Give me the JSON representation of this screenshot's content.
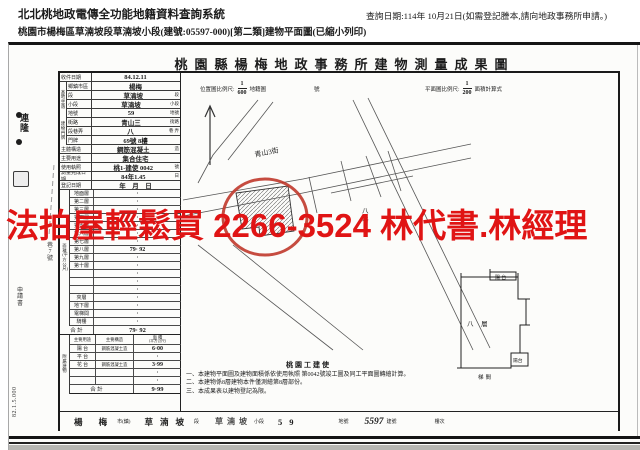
{
  "header": {
    "system_title": "北北桃地政電傳全功能地籍資料查詢系統",
    "query_date": "查詢日期:114年 10月21日(如需登記謄本,請向地政事務所申請。)",
    "doc_title": "桃園市楊梅區草湳坡段草湳坡小段(建號:05597-000)[第二類]建物平面圖(已縮小列印)"
  },
  "watermark": {
    "text": "法拍屋輕鬆買 2266-3524 林代書.林經理",
    "color": "#e01414"
  },
  "sheet": {
    "title": "桃園縣楊梅地政事務所建物測量成果圖",
    "scales": {
      "loc_label": "位置圖比例尺:",
      "loc_num": "1",
      "loc_den": "600",
      "loc_after": "地籍圖",
      "loc_no": "號",
      "plan_label": "平面圖比例尺:",
      "plan_num": "1",
      "plan_den": "200",
      "plan_after": "面積計算式"
    },
    "groups": {
      "g1": "基地坐落",
      "g2": "建物門牌"
    },
    "info_rows": [
      {
        "label": "收件日期",
        "value": "84.12.11",
        "unit": "",
        "cls": ""
      },
      {
        "label": "鄉鎮市區",
        "value": "楊梅",
        "unit": "",
        "cls": "g"
      },
      {
        "label": "段",
        "value": "草湳坡",
        "unit": "段",
        "cls": "g"
      },
      {
        "label": "小段",
        "value": "草湳坡",
        "unit": "小段",
        "cls": "g"
      },
      {
        "label": "地號",
        "value": "59",
        "unit": "地號",
        "cls": "g"
      },
      {
        "label": "街路",
        "value": "青山三",
        "unit": "街路",
        "cls": "g"
      },
      {
        "label": "段巷弄",
        "value": "八",
        "unit": "巷 弄",
        "cls": "g"
      },
      {
        "label": "門牌",
        "value": "69號 8樓",
        "unit": "",
        "cls": "g"
      },
      {
        "label": "主體構造",
        "value": "鋼筋混凝土",
        "unit": "造",
        "cls": ""
      },
      {
        "label": "主要用途",
        "value": "集合住宅",
        "unit": "",
        "cls": ""
      },
      {
        "label": "使用執照",
        "value": "桃1-建使 0042",
        "unit": "號",
        "cls": ""
      },
      {
        "label": "測量完成日期",
        "value": "84年1.45",
        "unit": "日",
        "cls": ""
      },
      {
        "label": "登記日期",
        "value": "年　月　日",
        "unit": "",
        "cls": ""
      }
    ],
    "floor": {
      "side": "面積(平方公尺)",
      "rows": [
        {
          "label": "地面層",
          "value": "·"
        },
        {
          "label": "第二層",
          "value": "·"
        },
        {
          "label": "第三層",
          "value": "·"
        },
        {
          "label": "第四層",
          "value": "·"
        },
        {
          "label": "第五層",
          "value": "·"
        },
        {
          "label": "第六層",
          "value": "·"
        },
        {
          "label": "第七層",
          "value": "·"
        },
        {
          "label": "第八層",
          "value": "79· 92"
        },
        {
          "label": "第九層",
          "value": "·"
        },
        {
          "label": "第十層",
          "value": "·"
        },
        {
          "label": "",
          "value": "·"
        },
        {
          "label": "",
          "value": "·"
        },
        {
          "label": "",
          "value": "·"
        },
        {
          "label": "夾層",
          "value": "·"
        },
        {
          "label": "地下層",
          "value": "·"
        },
        {
          "label": "電梯間",
          "value": "·"
        },
        {
          "label": "騎樓",
          "value": "·"
        }
      ],
      "total_label": "合 計",
      "total_value": "79· 92"
    },
    "annex": {
      "side": "附屬建物",
      "h_use": "主要用途",
      "h_struct": "主要構造",
      "h_area": "面 積",
      "h_area_sub": "(平方公尺)",
      "rows": [
        {
          "use": "陽 台",
          "struct": "鋼筋混凝土造",
          "area": "6·00"
        },
        {
          "use": "平 台",
          "struct": "",
          "area": "·"
        },
        {
          "use": "花 台",
          "struct": "鋼筋混凝土造",
          "area": "3·99"
        },
        {
          "use": "",
          "struct": "",
          "area": "·"
        },
        {
          "use": "",
          "struct": "",
          "area": "·"
        }
      ],
      "total_label": "合 計",
      "total_area": "9·99"
    },
    "notes": {
      "title": "桃園工建使",
      "lines": [
        {
          "t": "一、本建物平面圖及建物面積係依使用執照 第0042號竣工圖及同工平面圖轉繪計算。"
        },
        {
          "t": "二、本建物係8層建物本件僅測繪第8層部份。"
        },
        {
          "t": "三、本成果表以建物登記為限。"
        }
      ]
    },
    "sketch": {
      "street": "青山3街",
      "lane_a": "八",
      "lane_b": "巷",
      "floor_label": "八 層",
      "balcony_top": "陽 台",
      "balcony_bottom": "陽台",
      "stair": "梯間"
    },
    "bottom": [
      {
        "text": "楊 梅",
        "cls": "bs-big"
      },
      {
        "text": "市(鎮)",
        "cls": "bs-small"
      },
      {
        "text": "草湳坡",
        "cls": "bs-big"
      },
      {
        "text": "段",
        "cls": "bs-small"
      },
      {
        "text": "草湳坡",
        "cls": "bs-big2"
      },
      {
        "text": "小段",
        "cls": "bs-small"
      },
      {
        "text": "59",
        "cls": "bs-big"
      },
      {
        "text": "地號",
        "cls": "bs-small ml-big"
      },
      {
        "text": "5597",
        "cls": "bs-hand"
      },
      {
        "text": "建號",
        "cls": "bs-small"
      },
      {
        "text": "樓次",
        "cls": "bs-small ml-big"
      }
    ],
    "margin": {
      "stamp": "連隆",
      "apply": "申請書",
      "addr": "巷7號",
      "code": "82.1.5.000"
    }
  }
}
